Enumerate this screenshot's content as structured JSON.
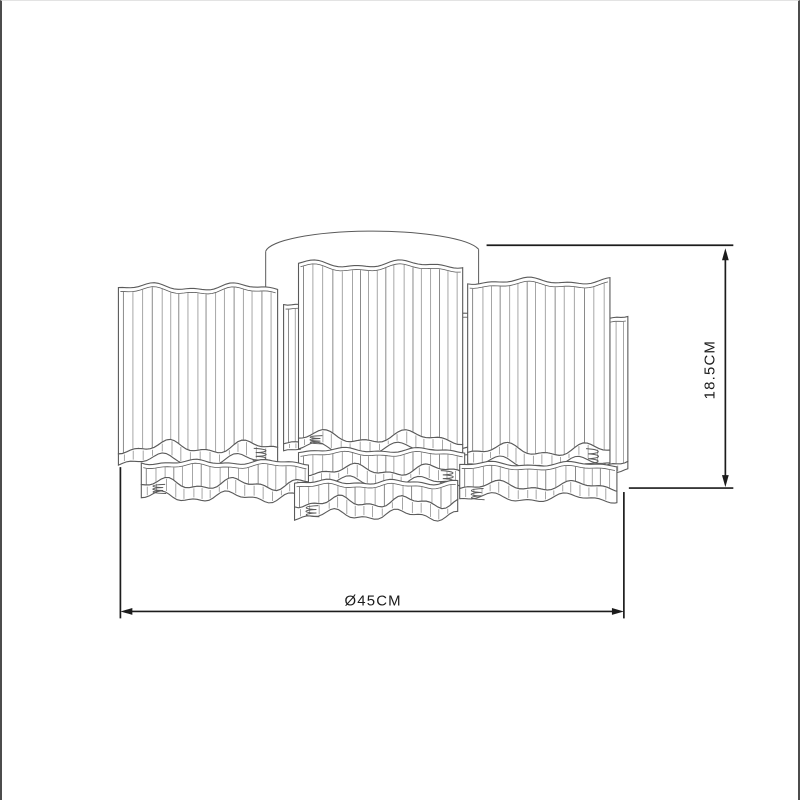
{
  "drawing": {
    "bottom_dimension": {
      "label": "Ø45CM"
    },
    "side_dimension": {
      "label": "18.5CM"
    }
  },
  "colors": {
    "background": "#ffffff",
    "sketch_outline": "#5a5a5a",
    "sketch_pleat": "#9c9c9c",
    "dimension": "#1c1c1c",
    "frame_border": "#4c4c4c"
  }
}
